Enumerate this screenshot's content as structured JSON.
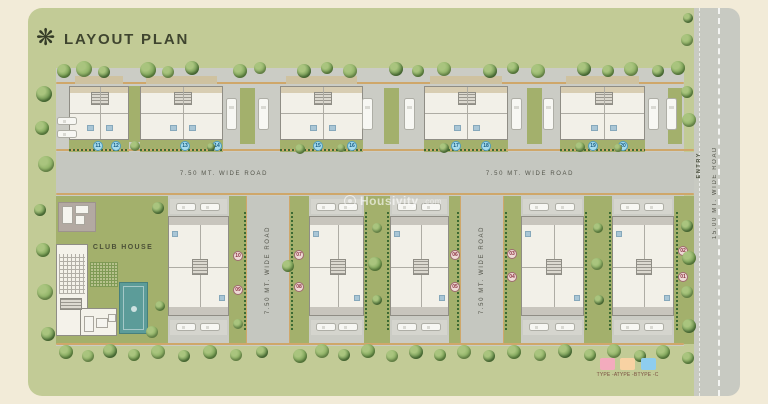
{
  "header": {
    "title": "LAYOUT PLAN"
  },
  "watermark": {
    "text": "Housivity",
    "suffix": ".com"
  },
  "club_house": {
    "label": "CLUB HOUSE"
  },
  "roads": {
    "h_left": "7.50 MT. WIDE ROAD",
    "h_right": "7.50 MT. WIDE ROAD",
    "v1": "7.50 MT. WIDE ROAD",
    "v2": "7.50 MT. WIDE ROAD",
    "entry_road": "15.00 MT. WIDE ROAD",
    "entry": "ENTRY"
  },
  "legend": {
    "items": [
      {
        "label": "TYPE -A",
        "color": "#f3abbd"
      },
      {
        "label": "TYPE -B",
        "color": "#f8d2a3"
      },
      {
        "label": "TYPE -C",
        "color": "#8ecdef"
      }
    ]
  },
  "top_badges": [
    {
      "n": "11",
      "x": 98,
      "y": 146
    },
    {
      "n": "12",
      "x": 116,
      "y": 146
    },
    {
      "n": "13",
      "x": 185,
      "y": 146
    },
    {
      "n": "14",
      "x": 217,
      "y": 146
    },
    {
      "n": "15",
      "x": 318,
      "y": 146
    },
    {
      "n": "16",
      "x": 352,
      "y": 146
    },
    {
      "n": "17",
      "x": 456,
      "y": 146
    },
    {
      "n": "18",
      "x": 486,
      "y": 146
    },
    {
      "n": "19",
      "x": 593,
      "y": 146
    },
    {
      "n": "20",
      "x": 623,
      "y": 146
    }
  ],
  "bottom_badges": [
    {
      "n": "10",
      "x": 238,
      "y": 256
    },
    {
      "n": "09",
      "x": 238,
      "y": 290
    },
    {
      "n": "07",
      "x": 299,
      "y": 255
    },
    {
      "n": "08",
      "x": 299,
      "y": 287
    },
    {
      "n": "06",
      "x": 455,
      "y": 255
    },
    {
      "n": "05",
      "x": 455,
      "y": 287
    },
    {
      "n": "03",
      "x": 512,
      "y": 254
    },
    {
      "n": "04",
      "x": 512,
      "y": 277
    },
    {
      "n": "02",
      "x": 683,
      "y": 251
    },
    {
      "n": "01",
      "x": 683,
      "y": 277
    }
  ],
  "colors": {
    "frame": "#f2ebd8",
    "panel": "#c2cb96",
    "site": "#cbccc5",
    "road": "#c5c7c0",
    "curb": "#cfa76a",
    "lawn": "#a3b06c",
    "building": "#f2f0e8",
    "wall": "#8f8d85",
    "pool": "#5c9c99",
    "badge_top_bg": "#a8dcec",
    "badge_top_text": "#14597f",
    "badge_bottom_bg": "#eedbd6",
    "badge_bottom_text": "#8c3040",
    "tree_shades": [
      "#6e9a4b",
      "#84ab5c",
      "#5d8843"
    ]
  },
  "plan": {
    "lawns": [
      [
        56,
        196,
        112,
        148
      ],
      [
        229,
        196,
        18,
        148
      ],
      [
        289,
        196,
        20,
        148
      ],
      [
        364,
        196,
        26,
        148
      ],
      [
        449,
        196,
        12,
        148
      ],
      [
        503,
        196,
        18,
        148
      ],
      [
        584,
        196,
        28,
        148
      ],
      [
        674,
        196,
        20,
        148
      ],
      [
        69,
        140,
        60,
        12
      ],
      [
        140,
        140,
        83,
        12
      ],
      [
        280,
        140,
        83,
        12
      ],
      [
        424,
        140,
        84,
        12
      ],
      [
        560,
        140,
        85,
        12
      ],
      [
        129,
        86,
        11,
        56
      ],
      [
        240,
        88,
        15,
        56
      ],
      [
        384,
        88,
        15,
        56
      ],
      [
        527,
        88,
        15,
        56
      ],
      [
        668,
        88,
        14,
        56
      ]
    ],
    "roads_v": [
      [
        247,
        196,
        42,
        148
      ],
      [
        461,
        196,
        42,
        148
      ]
    ],
    "curbs": [
      [
        56,
        149,
        638,
        2
      ],
      [
        56,
        193,
        638,
        2
      ],
      [
        56,
        343,
        628,
        2
      ],
      [
        56,
        82,
        628,
        1.5
      ],
      [
        245.5,
        196,
        1.5,
        148
      ],
      [
        288.5,
        196,
        1.5,
        148
      ],
      [
        459.5,
        196,
        1.5,
        148
      ],
      [
        502.5,
        196,
        1.5,
        148
      ]
    ],
    "hedges_h": [
      [
        69,
        149,
        60,
        2
      ],
      [
        140,
        149,
        83,
        2
      ],
      [
        280,
        149,
        83,
        2
      ],
      [
        424,
        149,
        84,
        2
      ],
      [
        560,
        149,
        85,
        2
      ]
    ],
    "hedges_v": [
      [
        244,
        210,
        2,
        120
      ],
      [
        291,
        210,
        2,
        120
      ],
      [
        457,
        210,
        2,
        120
      ],
      [
        505,
        210,
        2,
        120
      ],
      [
        676,
        210,
        2,
        120
      ],
      [
        365,
        210,
        2,
        120
      ],
      [
        387,
        210,
        2,
        120
      ],
      [
        585,
        210,
        2,
        120
      ],
      [
        609,
        210,
        2,
        120
      ]
    ],
    "backyards": [
      [
        75,
        76,
        48,
        8
      ],
      [
        146,
        76,
        71,
        8
      ],
      [
        286,
        76,
        71,
        8
      ],
      [
        430,
        76,
        72,
        8
      ],
      [
        566,
        76,
        73,
        8
      ]
    ],
    "pads": [
      [
        170,
        199,
        57,
        15
      ],
      [
        170,
        320,
        57,
        15
      ],
      [
        311,
        199,
        51,
        15
      ],
      [
        311,
        320,
        51,
        15
      ],
      [
        392,
        199,
        55,
        15
      ],
      [
        392,
        320,
        55,
        15
      ],
      [
        523,
        199,
        59,
        15
      ],
      [
        523,
        320,
        59,
        15
      ],
      [
        614,
        199,
        58,
        15
      ],
      [
        614,
        320,
        58,
        15
      ]
    ],
    "top_blocks": [
      [
        69,
        86,
        60,
        54
      ],
      [
        140,
        86,
        83,
        54
      ],
      [
        280,
        86,
        83,
        54
      ],
      [
        424,
        86,
        84,
        54
      ],
      [
        560,
        86,
        85,
        54
      ]
    ],
    "bottom_buildings": [
      [
        168,
        216,
        61,
        100
      ],
      [
        309,
        216,
        55,
        100
      ],
      [
        390,
        216,
        59,
        100
      ],
      [
        521,
        216,
        63,
        100
      ],
      [
        612,
        216,
        62,
        100
      ]
    ],
    "cars_v": [
      [
        226,
        98
      ],
      [
        258,
        98
      ],
      [
        362,
        98
      ],
      [
        404,
        98
      ],
      [
        511,
        98
      ],
      [
        543,
        98
      ],
      [
        648,
        98
      ],
      [
        666,
        98
      ]
    ],
    "cars_h": [
      [
        176,
        203
      ],
      [
        200,
        203
      ],
      [
        316,
        203
      ],
      [
        338,
        203
      ],
      [
        397,
        203
      ],
      [
        421,
        203
      ],
      [
        529,
        203
      ],
      [
        555,
        203
      ],
      [
        620,
        203
      ],
      [
        644,
        203
      ],
      [
        176,
        323
      ],
      [
        200,
        323
      ],
      [
        316,
        323
      ],
      [
        338,
        323
      ],
      [
        397,
        323
      ],
      [
        421,
        323
      ],
      [
        529,
        323
      ],
      [
        555,
        323
      ],
      [
        620,
        323
      ],
      [
        644,
        323
      ],
      [
        57,
        117
      ],
      [
        57,
        130
      ]
    ],
    "machines": [
      [
        62,
        206,
        9,
        16
      ],
      [
        75,
        205,
        12,
        7
      ],
      [
        75,
        215,
        8,
        8
      ],
      [
        84,
        316,
        8,
        14
      ],
      [
        96,
        318,
        10,
        8
      ],
      [
        108,
        314,
        6,
        6
      ]
    ],
    "trees": [
      [
        64,
        71,
        7,
        0
      ],
      [
        84,
        69,
        8,
        1
      ],
      [
        104,
        72,
        6,
        2
      ],
      [
        148,
        70,
        8,
        0
      ],
      [
        168,
        72,
        6,
        1
      ],
      [
        192,
        68,
        7,
        2
      ],
      [
        240,
        71,
        7,
        0
      ],
      [
        260,
        68,
        6,
        1
      ],
      [
        304,
        71,
        7,
        2
      ],
      [
        327,
        68,
        6,
        0
      ],
      [
        350,
        71,
        7,
        1
      ],
      [
        396,
        69,
        7,
        2
      ],
      [
        418,
        71,
        6,
        0
      ],
      [
        444,
        69,
        7,
        1
      ],
      [
        490,
        71,
        7,
        2
      ],
      [
        513,
        68,
        6,
        0
      ],
      [
        538,
        71,
        7,
        1
      ],
      [
        584,
        69,
        7,
        2
      ],
      [
        608,
        71,
        6,
        0
      ],
      [
        631,
        69,
        7,
        1
      ],
      [
        658,
        71,
        6,
        2
      ],
      [
        678,
        68,
        7,
        0
      ],
      [
        687,
        40,
        6,
        1
      ],
      [
        688,
        18,
        5,
        2
      ],
      [
        687,
        92,
        6,
        0
      ],
      [
        689,
        120,
        7,
        1
      ],
      [
        687,
        226,
        6,
        2
      ],
      [
        689,
        258,
        7,
        0
      ],
      [
        687,
        292,
        6,
        1
      ],
      [
        689,
        326,
        7,
        2
      ],
      [
        688,
        358,
        6,
        0
      ],
      [
        44,
        94,
        8,
        2
      ],
      [
        42,
        128,
        7,
        0
      ],
      [
        46,
        164,
        8,
        1
      ],
      [
        40,
        210,
        6,
        2
      ],
      [
        43,
        250,
        7,
        0
      ],
      [
        45,
        292,
        8,
        1
      ],
      [
        48,
        334,
        7,
        2
      ],
      [
        66,
        352,
        7,
        0
      ],
      [
        88,
        356,
        6,
        1
      ],
      [
        110,
        351,
        7,
        2
      ],
      [
        134,
        355,
        6,
        0
      ],
      [
        158,
        352,
        7,
        1
      ],
      [
        184,
        356,
        6,
        2
      ],
      [
        210,
        352,
        7,
        0
      ],
      [
        236,
        355,
        6,
        1
      ],
      [
        262,
        352,
        6,
        2
      ],
      [
        300,
        356,
        7,
        0
      ],
      [
        322,
        351,
        7,
        1
      ],
      [
        344,
        355,
        6,
        2
      ],
      [
        368,
        351,
        7,
        0
      ],
      [
        392,
        356,
        6,
        1
      ],
      [
        416,
        352,
        7,
        2
      ],
      [
        440,
        355,
        6,
        0
      ],
      [
        464,
        352,
        7,
        1
      ],
      [
        489,
        356,
        6,
        2
      ],
      [
        514,
        352,
        7,
        0
      ],
      [
        540,
        355,
        6,
        1
      ],
      [
        565,
        351,
        7,
        2
      ],
      [
        590,
        355,
        6,
        0
      ],
      [
        614,
        351,
        7,
        1
      ],
      [
        640,
        356,
        6,
        2
      ],
      [
        663,
        352,
        7,
        0
      ],
      [
        135,
        146,
        5,
        1
      ],
      [
        211,
        147,
        4,
        2
      ],
      [
        300,
        149,
        5,
        0
      ],
      [
        341,
        148,
        4,
        1
      ],
      [
        444,
        148,
        5,
        2
      ],
      [
        580,
        147,
        5,
        0
      ],
      [
        618,
        148,
        4,
        1
      ],
      [
        377,
        228,
        5,
        1
      ],
      [
        375,
        264,
        7,
        0
      ],
      [
        377,
        300,
        5,
        2
      ],
      [
        598,
        228,
        5,
        0
      ],
      [
        597,
        264,
        6,
        1
      ],
      [
        599,
        300,
        5,
        2
      ],
      [
        288,
        266,
        6,
        0
      ],
      [
        238,
        324,
        5,
        1
      ],
      [
        158,
        208,
        6,
        2
      ],
      [
        160,
        306,
        5,
        0
      ],
      [
        152,
        332,
        6,
        1
      ]
    ],
    "legend_slots": [
      [
        600,
        358
      ],
      [
        620,
        358
      ],
      [
        641,
        358
      ]
    ]
  }
}
